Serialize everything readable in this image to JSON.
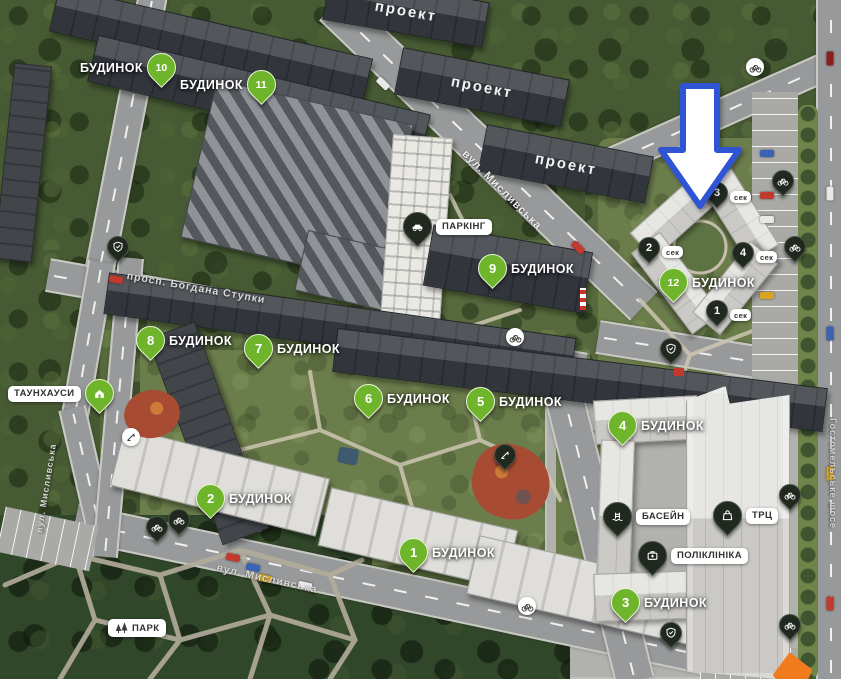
{
  "map": {
    "project_labels": [
      "проект",
      "проект",
      "проект"
    ],
    "building_labels": [
      {
        "number": "10",
        "word": "БУДИНОК"
      },
      {
        "number": "11",
        "word": "БУДИНОК"
      },
      {
        "number": "9",
        "word": "БУДИНОК"
      },
      {
        "number": "8",
        "word": "БУДИНОК"
      },
      {
        "number": "7",
        "word": "БУДИНОК"
      },
      {
        "number": "6",
        "word": "БУДИНОК"
      },
      {
        "number": "5",
        "word": "БУДИНОК"
      },
      {
        "number": "2",
        "word": "БУДИНОК"
      },
      {
        "number": "1",
        "word": "БУДИНОК"
      },
      {
        "number": "12",
        "word": "БУДИНОК"
      },
      {
        "number": "4",
        "word": "БУДИНОК"
      },
      {
        "number": "3",
        "word": "БУДИНОК"
      }
    ],
    "sections": [
      {
        "number": "3",
        "label": "сек"
      },
      {
        "number": "2",
        "label": "сек"
      },
      {
        "number": "4",
        "label": "сек"
      },
      {
        "number": "1",
        "label": "сек"
      }
    ],
    "amenities": {
      "parking": "ПАРКІНГ",
      "townhouses": "ТАУНХАУСИ",
      "pool": "БАСЕЙН",
      "clinic": "ПОЛІКЛІНІКА",
      "mall": "ТРЦ",
      "park": "ПАРК"
    },
    "streets": {
      "top": "вул. Мисливська",
      "avenue": "просп. Богдана Ступки",
      "bottom": "вул. Мисливська",
      "left": "вул. Мисливська",
      "right": "Гостомельське шосе"
    },
    "colors": {
      "pin_green": "#6fb52b",
      "pin_dark": "#20281f",
      "arrow_blue": "#2f55d4",
      "tent_orange": "#f07c1e"
    }
  }
}
